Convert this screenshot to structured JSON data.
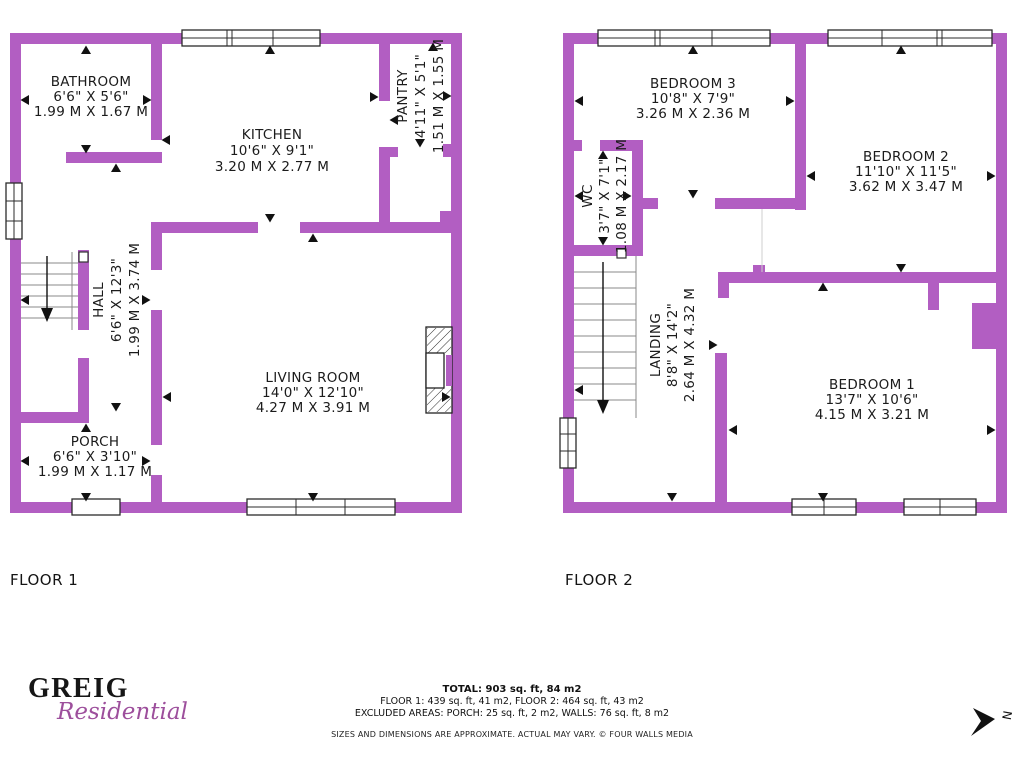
{
  "colors": {
    "wall": "#b25ec2",
    "script": "#9d4f9c"
  },
  "floors": [
    {
      "label": "FLOOR 1",
      "rooms": [
        {
          "name": "BATHROOM",
          "imperial": "6'6\" X 5'6\"",
          "metric": "1.99 M X 1.67 M"
        },
        {
          "name": "KITCHEN",
          "imperial": "10'6\" X 9'1\"",
          "metric": "3.20 M X 2.77 M"
        },
        {
          "name": "PANTRY",
          "imperial": "4'11\" X 5'1\"",
          "metric": "1.51 M X 1.55 M"
        },
        {
          "name": "HALL",
          "imperial": "6'6\" X 12'3\"",
          "metric": "1.99 M X 3.74 M"
        },
        {
          "name": "LIVING ROOM",
          "imperial": "14'0\" X 12'10\"",
          "metric": "4.27 M X 3.91 M"
        },
        {
          "name": "PORCH",
          "imperial": "6'6\" X 3'10\"",
          "metric": "1.99 M X 1.17 M"
        }
      ]
    },
    {
      "label": "FLOOR 2",
      "rooms": [
        {
          "name": "BEDROOM 3",
          "imperial": "10'8\" X 7'9\"",
          "metric": "3.26 M X 2.36 M"
        },
        {
          "name": "BEDROOM 2",
          "imperial": "11'10\" X 11'5\"",
          "metric": "3.62 M X 3.47 M"
        },
        {
          "name": "WC",
          "imperial": "3'7\" X 7'1\"",
          "metric": "1.08 M X 2.17 M"
        },
        {
          "name": "LANDING",
          "imperial": "8'8\" X 14'2\"",
          "metric": "2.64 M X 4.32 M"
        },
        {
          "name": "BEDROOM 1",
          "imperial": "13'7\" X 10'6\"",
          "metric": "4.15 M X 3.21 M"
        }
      ]
    }
  ],
  "branding": {
    "name": "GREIG",
    "sub": "Residential"
  },
  "summary": {
    "total": "TOTAL: 903 sq. ft, 84 m2",
    "floors_line": "FLOOR 1: 439 sq. ft, 41 m2, FLOOR 2: 464 sq. ft, 43 m2",
    "excluded_line": "EXCLUDED AREAS: PORCH: 25 sq. ft, 2 m2, WALLS: 76 sq. ft, 8 m2",
    "disclaimer": "SIZES AND DIMENSIONS ARE APPROXIMATE. ACTUAL MAY VARY. © FOUR WALLS MEDIA"
  },
  "compass": {
    "label": "N"
  }
}
